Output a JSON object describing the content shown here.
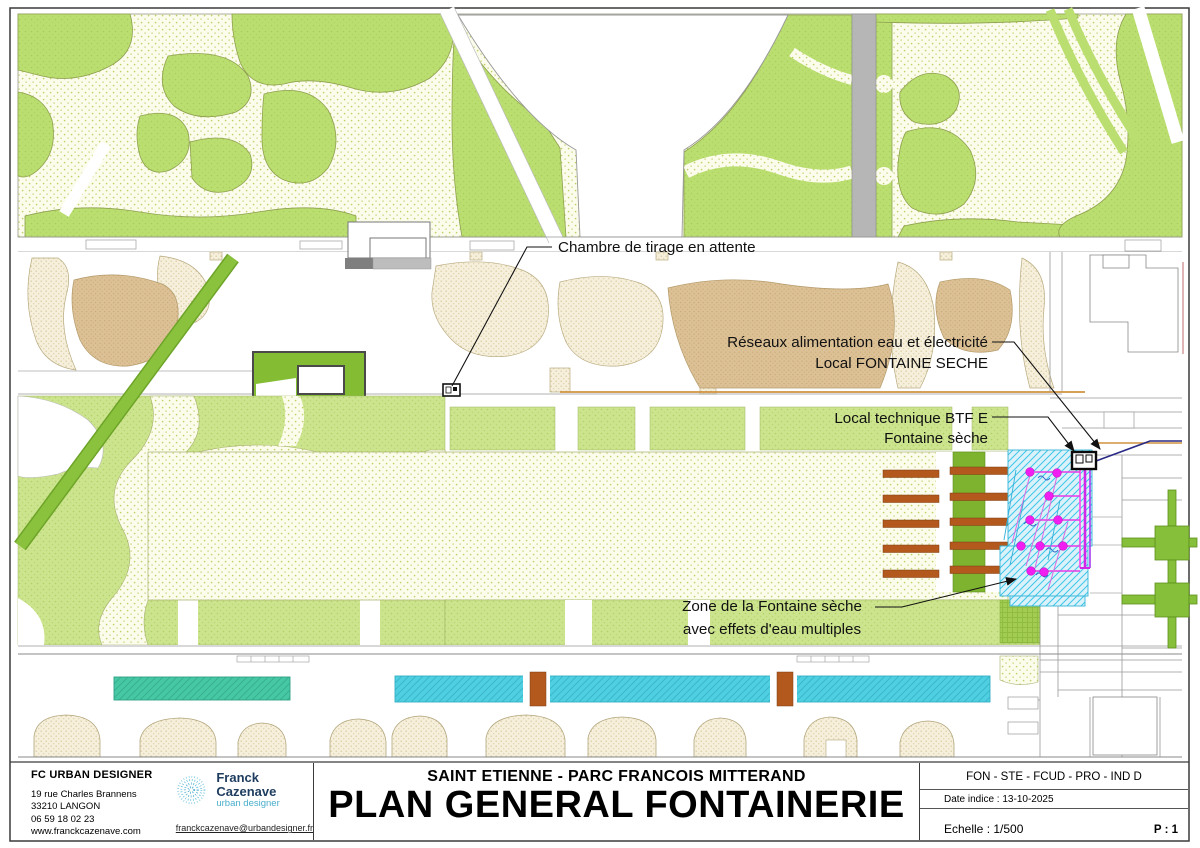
{
  "annotations": {
    "chambre_de_tirage": "Chambre de tirage en attente",
    "reseaux_line1": "Réseaux alimentation eau et électricité",
    "reseaux_line2": "Local FONTAINE SECHE",
    "local_technique_line1": "Local technique BTF E",
    "local_technique_line2": "Fontaine sèche",
    "zone_fontaine_line1": "Zone de la Fontaine sèche",
    "zone_fontaine_line2": "avec effets d'eau multiples"
  },
  "title_block": {
    "company": {
      "name": "FC URBAN DESIGNER",
      "address_line1": "19 rue Charles Brannens",
      "address_line2": "33210 LANGON",
      "phone": "06 59 18 02 23",
      "website": "www.franckcazenave.com"
    },
    "logo": {
      "name": "Franck Cazenave",
      "tagline": "urban designer",
      "email": "franckcazenave@urbandesigner.fr"
    },
    "project_title": "SAINT ETIENNE - PARC FRANCOIS MITTERAND",
    "drawing_title": "PLAN GENERAL FONTAINERIE",
    "reference_code": "FON - STE - FCUD - PRO - IND D",
    "date_indice": "Date indice : 13-10-2025",
    "scale": "Echelle : 1/500",
    "page": "P : 1"
  },
  "palette": {
    "park_green": "#bade70",
    "mid_green": "#cce48d",
    "bright_green": "#84bd34",
    "lawn_cream": "#fbfbe8",
    "sand_tan": "#dcc197",
    "pool_cyan": "#4ed0e2",
    "pool_teal": "#47c8a5",
    "fountain_zone_cyan": "#dcf2fb",
    "nozzle_magenta": "#f01ef0",
    "deck_brown": "#b3591d",
    "network_orange": "#cf9340",
    "network_navy": "#2a2a85",
    "path_gray": "#b6b6b6"
  }
}
